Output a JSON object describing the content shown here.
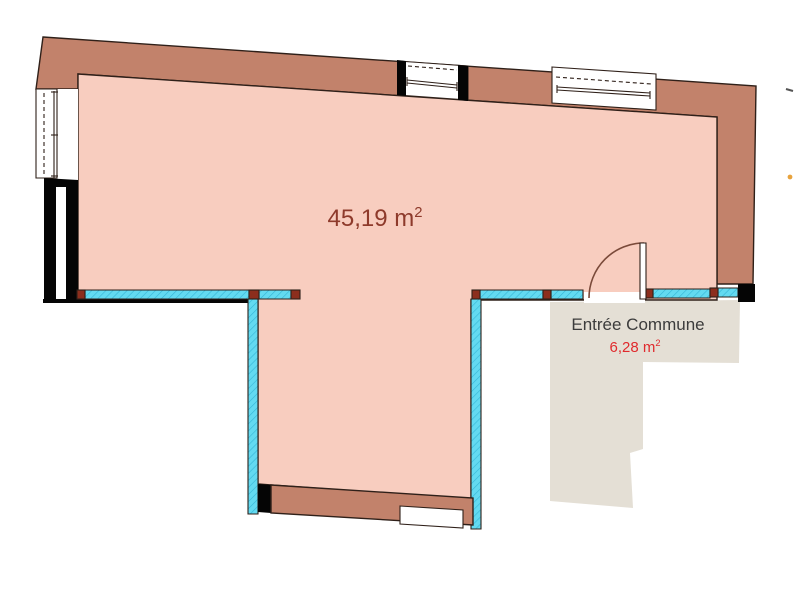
{
  "plan": {
    "main_room": {
      "area_text": "45,19 m",
      "area_exponent": "2"
    },
    "entrance": {
      "label": "Entrée Commune",
      "area_text": "6,28 m",
      "area_exponent": "2"
    }
  },
  "colors": {
    "wall_fill": "#c2826b",
    "room_fill": "#f8cdbf",
    "entry_floor_fill": "#e4dfd5",
    "glazing_cyan": "#63daf1",
    "glazing_hatch": "#35b6d6",
    "sill_marker_red": "#8c2e1d",
    "outline_dark": "#2f2019",
    "wall_black": "#050505",
    "window_white": "#ffffff",
    "door_arc": "#7a4a3a",
    "main_area_text": "#8e3a2b",
    "entrance_label_text": "#3c3c3c",
    "entrance_area_text": "#e02a2d",
    "edge_mark_orange": "#e8a33d"
  }
}
